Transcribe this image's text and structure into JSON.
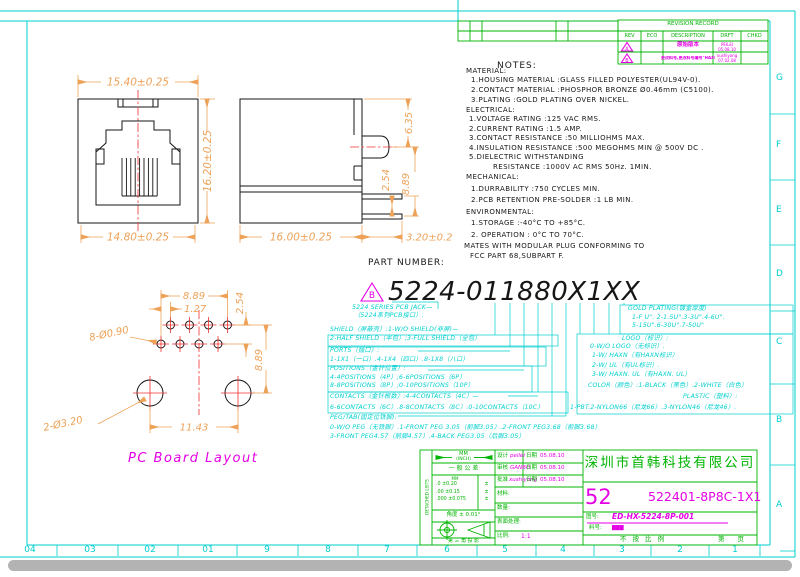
{
  "frame": {
    "cols": [
      "04",
      "03",
      "02",
      "01",
      "9",
      "8",
      "7",
      "6",
      "5",
      "4",
      "3",
      "2",
      "1"
    ],
    "rows": [
      "G",
      "F",
      "E",
      "D",
      "C",
      "B",
      "A"
    ]
  },
  "revision": {
    "title": "REVISION RECORD",
    "cols": [
      "REV",
      "ECO",
      "DESCRIPTION",
      "DRFT",
      "CHKD"
    ],
    "rows": [
      {
        "rev": "A",
        "desc": "原始版本",
        "by": "PEILEI",
        "date": "05.08.10"
      },
      {
        "rev": "B",
        "desc": "更改料号,更改料号编号\"HAXN\"",
        "by": "xushiyong",
        "date": "07.02.08"
      }
    ]
  },
  "notes": {
    "title": "NOTES:",
    "material": {
      "h": "MATERIAL:",
      "l": [
        "1.HOUSING  MATERIAL :GLASS  FILLED  POLYESTER(UL94V-0).",
        "2.CONTACT  MATERIAL  :PHOSPHOR  BRONZE  Ø0.46mm  (C5100).",
        "3.PLATING :GOLD  PLATING  OVER  NICKEL."
      ]
    },
    "electrical": {
      "h": "ELECTRICAL:",
      "l": [
        "1.VOLTAGE  RATING  :125  VAC  RMS.",
        "2.CURRENT  RATING  :1.5  AMP.",
        "3.CONTACT  RESISTANCE :50  MILLIOHMS  MAX.",
        "4.INSULATION  RESISTANCE  :500  MEGOHMS  MIN  @  500V  DC .",
        "5.DIELECTRIC  WITHSTANDING",
        "RESISTANCE :1000V  AC  RMS  50Hz.  1MIN."
      ]
    },
    "mechanical": {
      "h": "MECHANICAL:",
      "l": [
        "1.DURRABILITY  :750  CYCLES  MIN.",
        "2.PCB  RETENTION  PRE-SOLDER :1  LB  MIN."
      ]
    },
    "environmental": {
      "h": "ENVIRONMENTAL:",
      "l": [
        "1.STORAGE :-40°C  TO  +85°C.",
        "2. OPERATION : 0°C  TO  70°C."
      ]
    },
    "footer": [
      "MATES  WITH  MODULAR  PLUG  CONFORMING  TO",
      "FCC  PART  68,SUBPART  F."
    ]
  },
  "pn": {
    "label": "PART NUMBER:",
    "rev": "B",
    "value": "5224-011880X1XX",
    "left": [
      "5224 SERIES PCB JACK—",
      "（5224系列PCB接口）.",
      "SHIELD（屏蔽壳）:1-W/O SHIELD(非屏)—",
      "2-HALF SHIELD（半包）;3-FULL SHIELD（全包）",
      "PORTS（插口）:",
      "1-1X1（一口）.4-1X4（四口）.8-1X8（八口）",
      "POSITIONS（金针位置）:",
      "4-4POSITIONS（4P）;6-6POSITIONS（6P）",
      "8-8POSITIONS（8P）;0-10POSITIONS（10P）",
      "CONTACTS（金针根数）:4-4CONTACTS（4C）—",
      "6-6CONTACTS（6C）.8-8CONTACTS（8C）.0-10CONTACTS（10C）",
      "PEG/TAB(固定位铁脚):",
      "0-W/O PEG（无铁脚）.1-FRONT PEG 3.05（前脚3.05）.2-FRONT PEG3.68（前脚3.68）",
      "3-FRONT PEG4.57（前脚4.57）.4-BACK PEG3.05（后脚3.05）"
    ],
    "right": [
      "GOLD PLATING(镀金厚度)",
      "1-F U\". 2-1.5U\".3-3U\".4-6U\".",
      "5-15U\".6-30U\".7-50U\"",
      "LOGO（标识）:",
      "0-W/O LOGO（无标识）.",
      "1-W/ HAXN（有HAXN标识）",
      "2-W/ UL（有UL标识）.",
      "3-W/ HAXN. UL（有HAXN. UL）",
      "COLOR（颜色）:1-BLACK（黑色）.2-WHITE（白色）",
      "PLASTIC（塑料）:",
      "1-PBT.2-NYLON66（尼龙66）.3-NYLON46（尼龙46）."
    ]
  },
  "dims": {
    "front_w_top": "15.40±0.25",
    "front_h": "16.20±0.25",
    "front_w_bot": "14.80±0.25",
    "side_w": "16.00±0.25",
    "side_pin": "3.20±0.2",
    "side_top": "6.35",
    "side_pitch": "2.54",
    "side_h": "8.89",
    "pcb_span": "8.89",
    "pcb_pitch": "1.27",
    "pcb_row": "2.54",
    "pcb_small": "8-Ø0.90",
    "pcb_h": "8.89",
    "pcb_big": "2-Ø3.20",
    "pcb_w": "11.43",
    "caption": "PC Board Layout"
  },
  "tb": {
    "units": "MM",
    "units_in": "(INCH)",
    "gen_tol": "一 般 公 差",
    "tol_unit": "MM",
    "tol_rows": [
      ".0  ±0.20",
      ".00  ±0.15",
      ".000  ±0.075"
    ],
    "pm": "±",
    "angle": "角度 ± 0.01°",
    "proj": "第 三 角 投 影",
    "strip": "DETACHED LISTS",
    "sig": [
      {
        "label": "设计",
        "name": "peilei",
        "date_label": "日期",
        "date": "05.08.10"
      },
      {
        "label": "审核",
        "name": "GANBO",
        "date_label": "日期",
        "date": "05.08.10"
      },
      {
        "label": "批准",
        "name": "xushiyong",
        "date_label": "日期",
        "date": "05.08.10"
      }
    ],
    "material": "材料:",
    "qty": "数量:",
    "finish": "表面处理:",
    "scale_label": "比例:",
    "scale": "1:1",
    "company": "深圳市首韩科技有限公司",
    "size": "52",
    "part": "522401-8P8C-1X1",
    "dwg_label": "图号:",
    "dwg": "ED-HX-5224-8P-001",
    "mat_label": "料号:",
    "mat": "▇▇▇",
    "nts": "不 按 比 例",
    "page": "第　　页"
  },
  "colors": {
    "cyan": "#00CFCF",
    "green": "#00B400",
    "magenta": "#E400E4",
    "dim_orange": "#EDA258",
    "centerline_red": "#F03030",
    "line_black": "#151515"
  }
}
